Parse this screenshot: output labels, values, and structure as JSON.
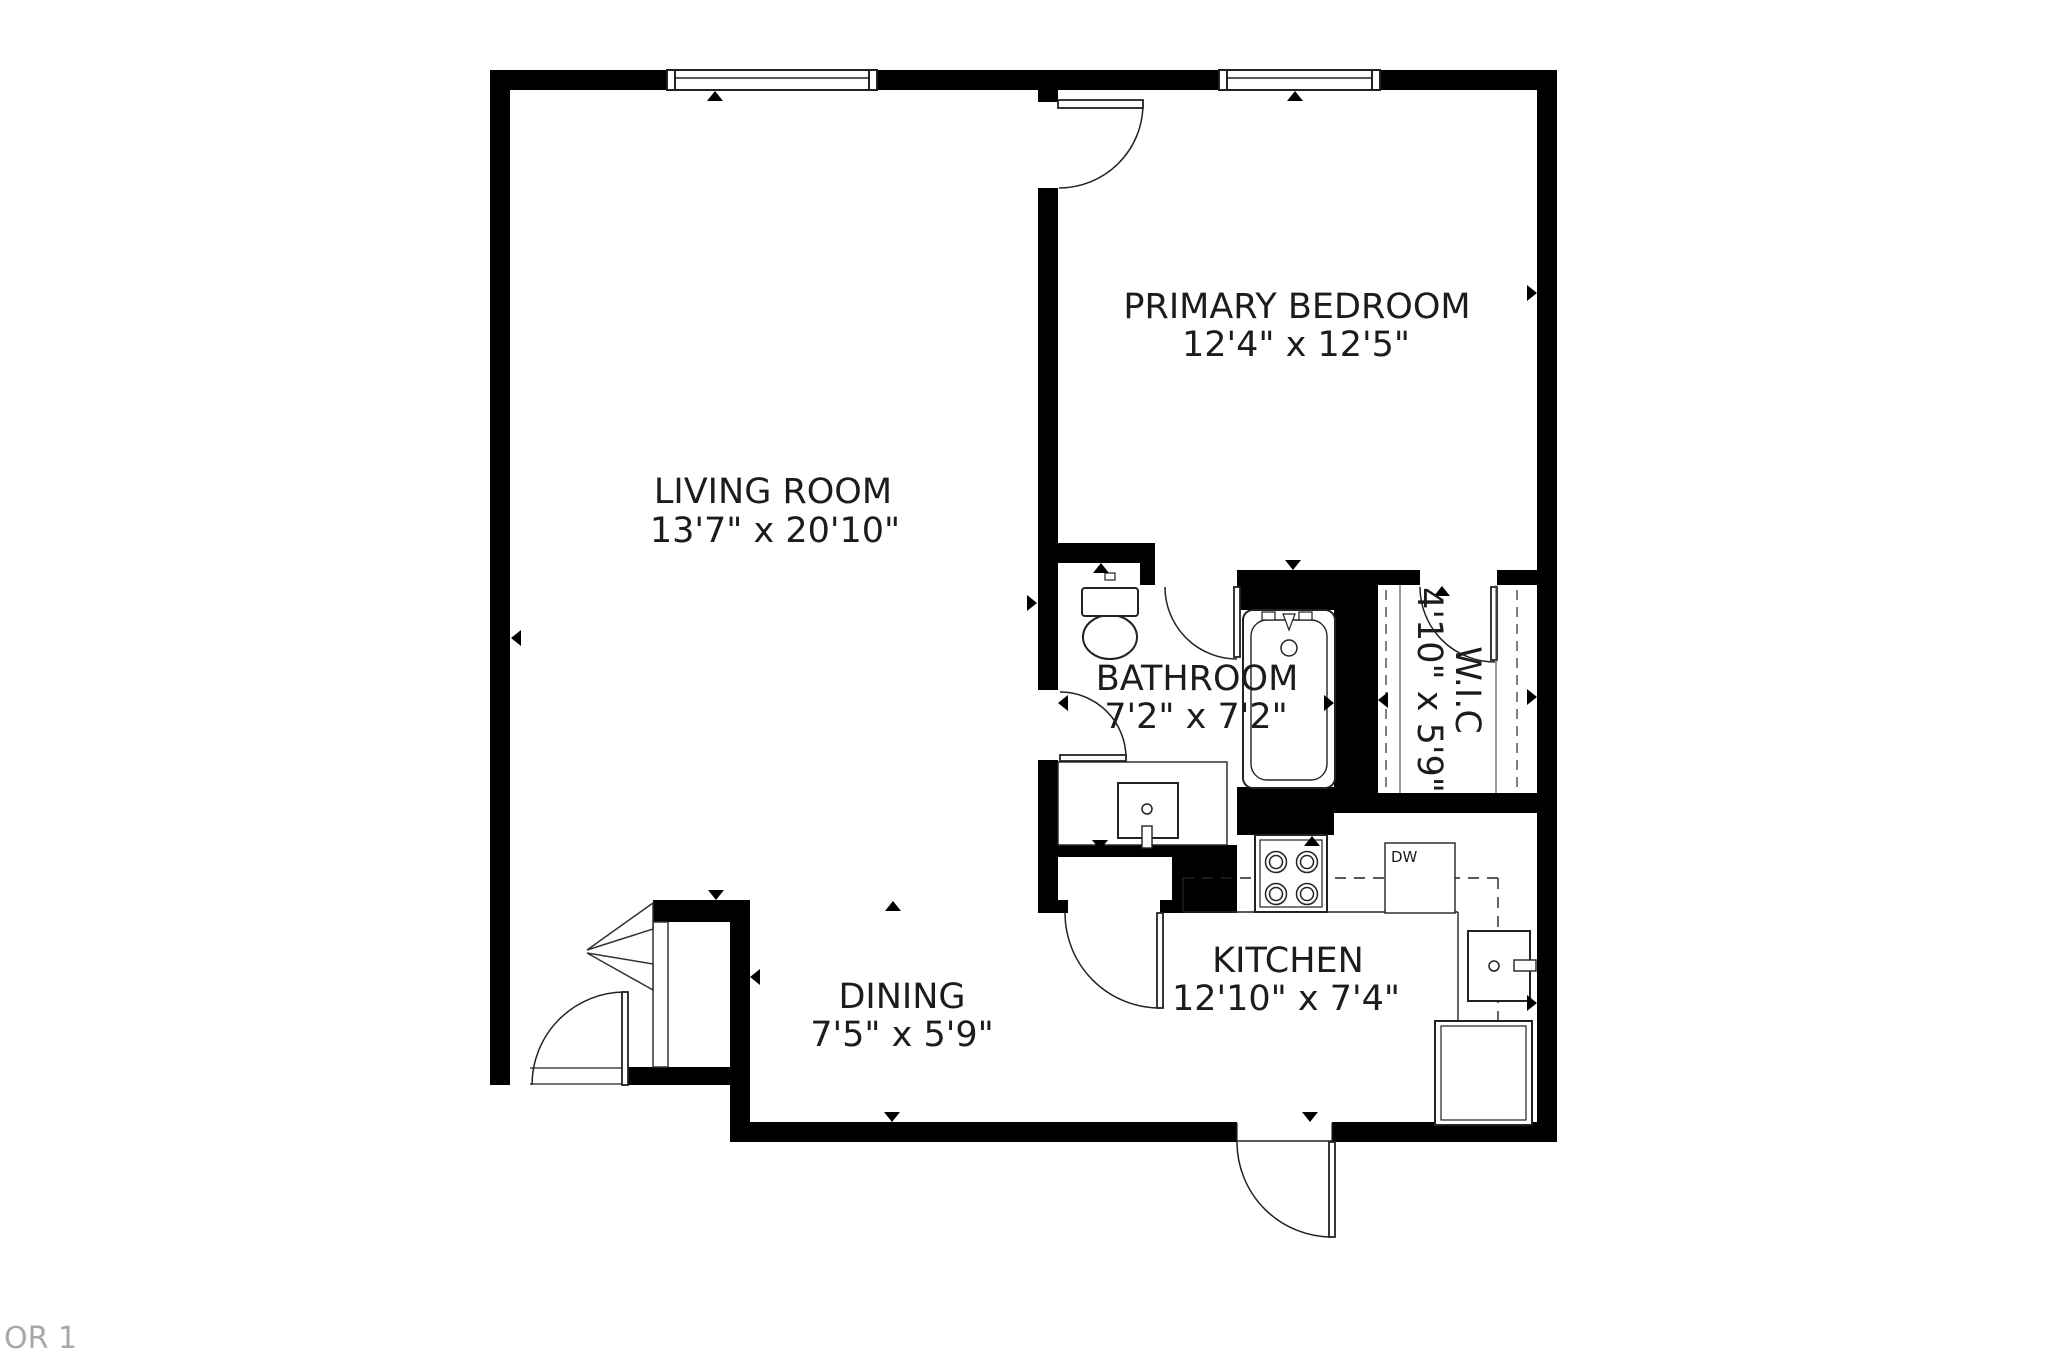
{
  "footer": {
    "label": "OR 1"
  },
  "rooms": {
    "living": {
      "name": "LIVING ROOM",
      "dims": "13'7\" x 20'10\""
    },
    "bedroom": {
      "name": "PRIMARY BEDROOM",
      "dims": "12'4\" x 12'5\""
    },
    "bathroom": {
      "name": "BATHROOM",
      "dims": "7'2\" x 7'2\""
    },
    "wic": {
      "name": "W.I.C",
      "dims": "4'10\" x 5'9\""
    },
    "dining": {
      "name": "DINING",
      "dims": "7'5\" x 5'9\""
    },
    "kitchen": {
      "name": "KITCHEN",
      "dims": "12'10\" x 7'4\""
    }
  },
  "appliances": {
    "dishwasher": "DW"
  },
  "colors": {
    "wall": "#000000",
    "text": "#1c1c1c",
    "muted": "#a8a8a8",
    "line": "#222222"
  },
  "markers": [
    {
      "x": 715,
      "y": 96,
      "dir": "up"
    },
    {
      "x": 1295,
      "y": 96,
      "dir": "up"
    },
    {
      "x": 516,
      "y": 638,
      "dir": "left"
    },
    {
      "x": 1032,
      "y": 603,
      "dir": "right"
    },
    {
      "x": 1101,
      "y": 568,
      "dir": "up"
    },
    {
      "x": 1293,
      "y": 565,
      "dir": "down"
    },
    {
      "x": 1442,
      "y": 591,
      "dir": "up"
    },
    {
      "x": 1329,
      "y": 703,
      "dir": "right"
    },
    {
      "x": 1383,
      "y": 700,
      "dir": "left"
    },
    {
      "x": 1532,
      "y": 697,
      "dir": "right"
    },
    {
      "x": 1063,
      "y": 703,
      "dir": "left"
    },
    {
      "x": 1100,
      "y": 845,
      "dir": "down"
    },
    {
      "x": 1312,
      "y": 841,
      "dir": "up"
    },
    {
      "x": 1532,
      "y": 1003,
      "dir": "right"
    },
    {
      "x": 892,
      "y": 1117,
      "dir": "down"
    },
    {
      "x": 1310,
      "y": 1117,
      "dir": "down"
    },
    {
      "x": 716,
      "y": 895,
      "dir": "down"
    },
    {
      "x": 755,
      "y": 977,
      "dir": "left"
    },
    {
      "x": 893,
      "y": 906,
      "dir": "up"
    },
    {
      "x": 1532,
      "y": 293,
      "dir": "right"
    }
  ]
}
